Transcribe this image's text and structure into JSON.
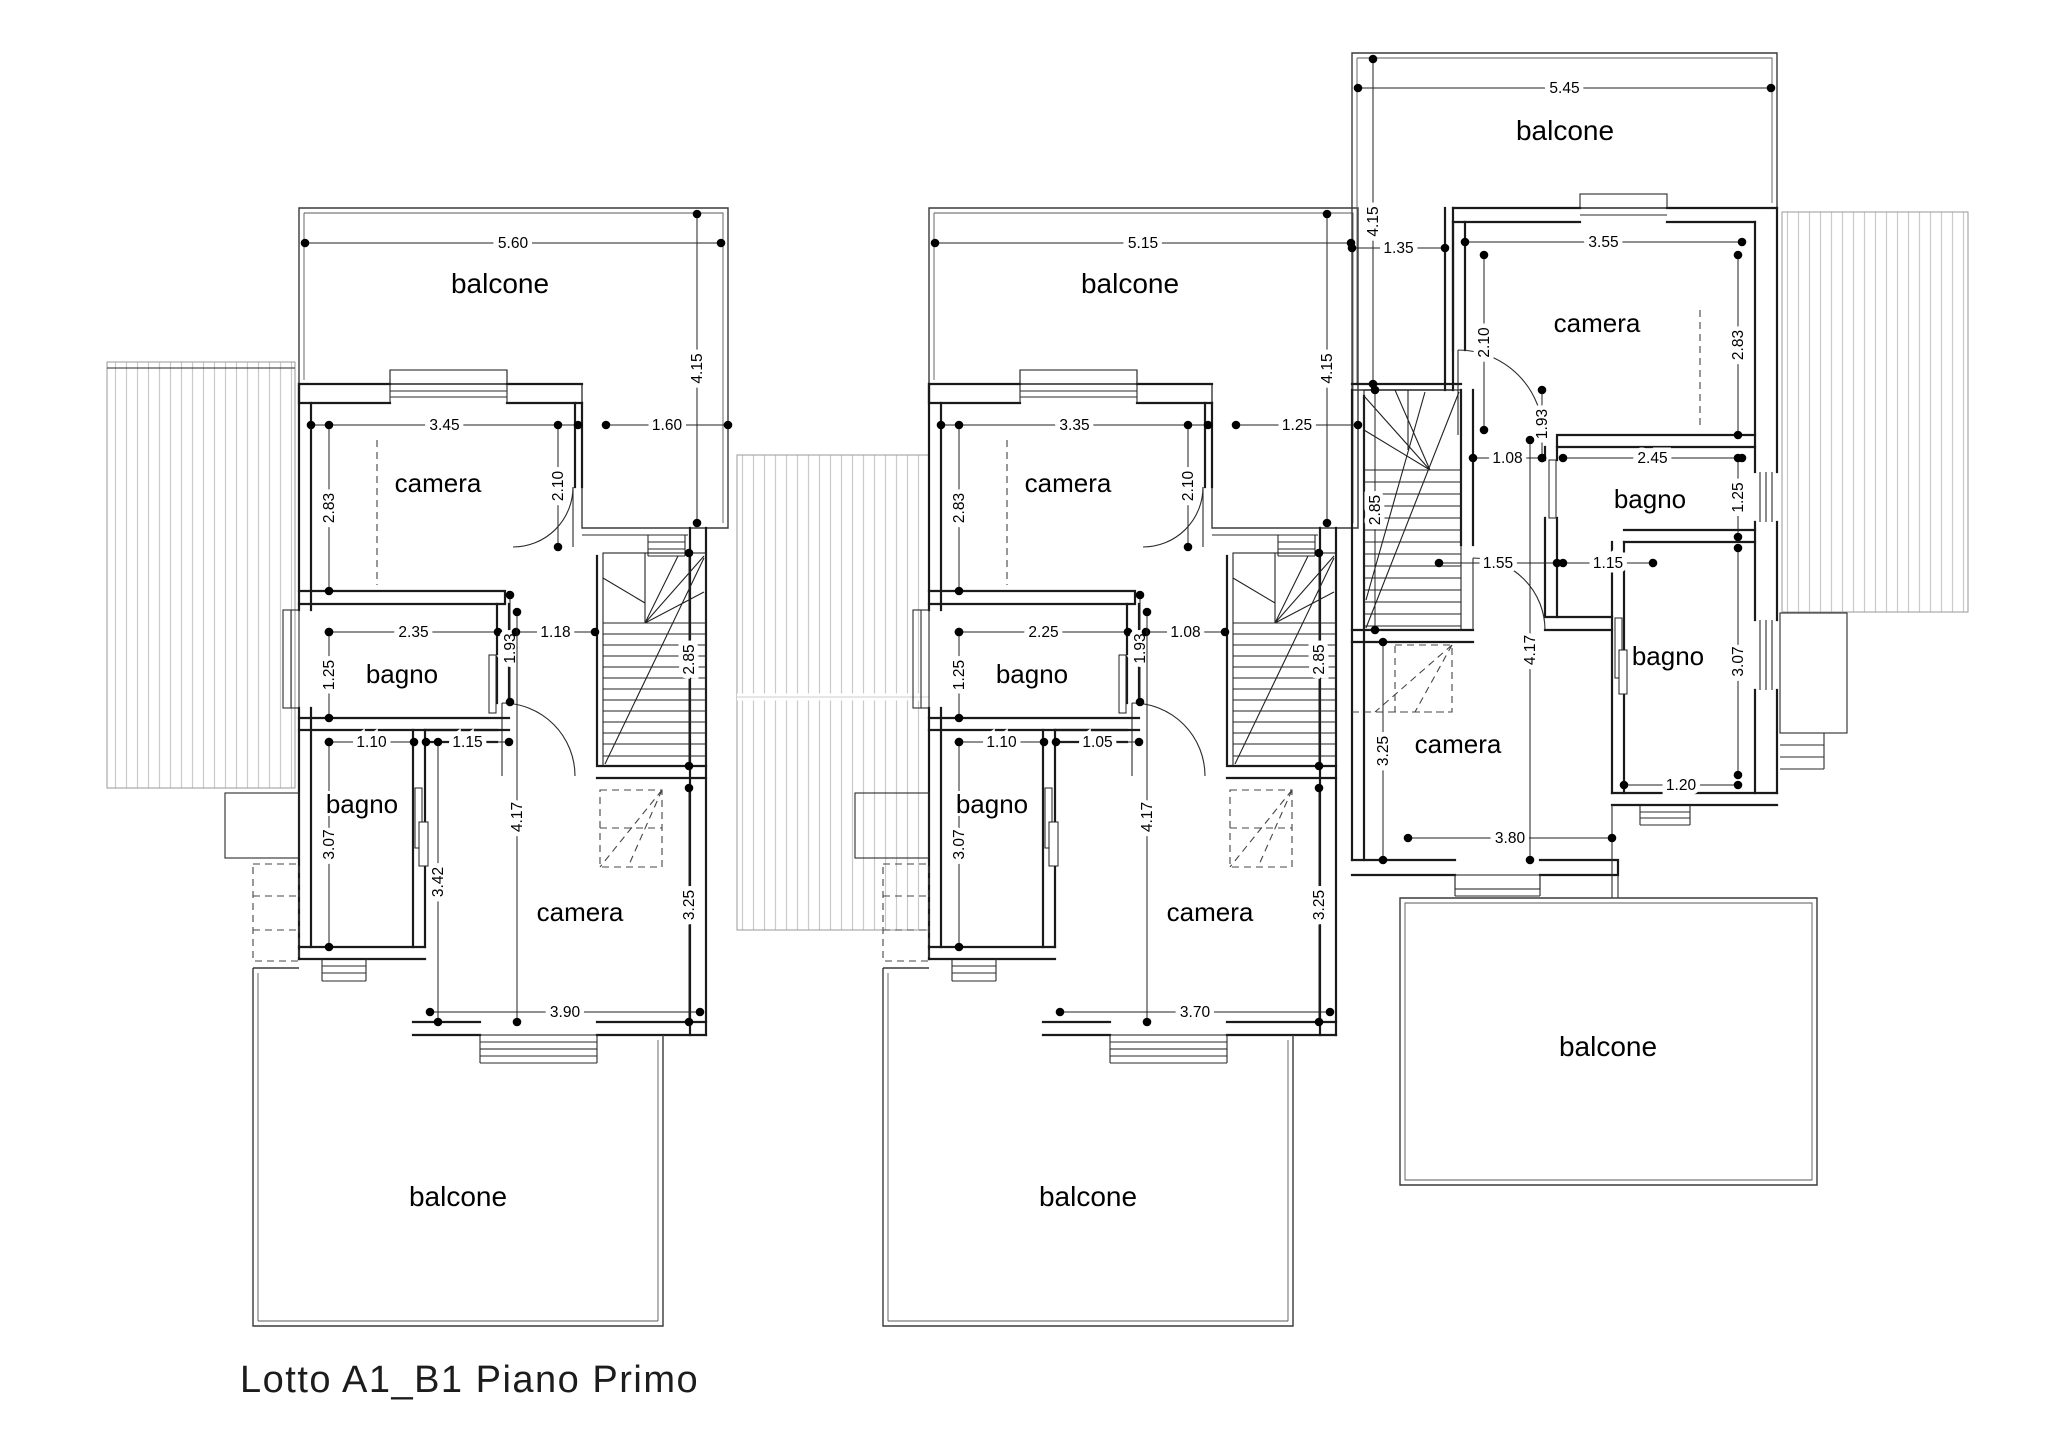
{
  "title": "Lotto A1_B1 Piano Primo",
  "plan": {
    "dot_radius": 4.3,
    "units": [
      {
        "id": "a",
        "rooms": [
          {
            "label": "balcone",
            "x": 500,
            "y": 293,
            "fs": 28
          },
          {
            "label": "camera",
            "x": 438,
            "y": 492,
            "fs": 26
          },
          {
            "label": "bagno",
            "x": 402,
            "y": 683,
            "fs": 26
          },
          {
            "label": "bagno",
            "x": 362,
            "y": 813,
            "fs": 26
          },
          {
            "label": "camera",
            "x": 580,
            "y": 921,
            "fs": 26
          },
          {
            "label": "balcone",
            "x": 458,
            "y": 1206,
            "fs": 28
          }
        ],
        "dims": [
          {
            "v": "5.60",
            "o": "h",
            "x1": 305,
            "x2": 721,
            "y": 243
          },
          {
            "v": "4.15",
            "o": "v",
            "x": 697,
            "y1": 214,
            "y2": 523
          },
          {
            "v": "3.45",
            "o": "h",
            "x1": 311,
            "x2": 578,
            "y": 425
          },
          {
            "v": "1.60",
            "o": "h",
            "x1": 606,
            "x2": 728,
            "y": 425
          },
          {
            "v": "2.83",
            "o": "v",
            "x": 329,
            "y1": 425,
            "y2": 591
          },
          {
            "v": "2.10",
            "o": "v",
            "x": 558,
            "y1": 425,
            "y2": 547
          },
          {
            "v": "2.35",
            "o": "h",
            "x1": 329,
            "x2": 498,
            "y": 632
          },
          {
            "v": "1.93",
            "o": "v",
            "x": 510,
            "y1": 595,
            "y2": 702
          },
          {
            "v": "1.18",
            "o": "h",
            "x1": 516,
            "x2": 595,
            "y": 632
          },
          {
            "v": "1.25",
            "o": "v",
            "x": 329,
            "y1": 632,
            "y2": 718
          },
          {
            "v": "2.85",
            "o": "v",
            "x": 689,
            "y1": 553,
            "y2": 766
          },
          {
            "v": "1.10",
            "o": "h",
            "x1": 329,
            "x2": 414,
            "y": 742
          },
          {
            "v": "1.15",
            "o": "h",
            "x1": 426,
            "x2": 509,
            "y": 742
          },
          {
            "v": "3.07",
            "o": "v",
            "x": 329,
            "y1": 742,
            "y2": 947
          },
          {
            "v": "3.42",
            "o": "v",
            "x": 438,
            "y1": 742,
            "y2": 1022
          },
          {
            "v": "4.17",
            "o": "v",
            "x": 517,
            "y1": 612,
            "y2": 1022
          },
          {
            "v": "3.25",
            "o": "v",
            "x": 689,
            "y1": 788,
            "y2": 1022
          },
          {
            "v": "3.90",
            "o": "h",
            "x1": 430,
            "x2": 700,
            "y": 1012
          }
        ]
      },
      {
        "id": "b",
        "rooms": [
          {
            "label": "balcone",
            "x": 1130,
            "y": 293,
            "fs": 28
          },
          {
            "label": "camera",
            "x": 1068,
            "y": 492,
            "fs": 26
          },
          {
            "label": "bagno",
            "x": 1032,
            "y": 683,
            "fs": 26
          },
          {
            "label": "bagno",
            "x": 992,
            "y": 813,
            "fs": 26
          },
          {
            "label": "camera",
            "x": 1210,
            "y": 921,
            "fs": 26
          },
          {
            "label": "balcone",
            "x": 1088,
            "y": 1206,
            "fs": 28
          }
        ],
        "dims": [
          {
            "v": "5.15",
            "o": "h",
            "x1": 935,
            "x2": 1351,
            "y": 243
          },
          {
            "v": "4.15",
            "o": "v",
            "x": 1327,
            "y1": 214,
            "y2": 523
          },
          {
            "v": "3.35",
            "o": "h",
            "x1": 941,
            "x2": 1208,
            "y": 425
          },
          {
            "v": "1.25",
            "o": "h",
            "x1": 1236,
            "x2": 1358,
            "y": 425
          },
          {
            "v": "2.83",
            "o": "v",
            "x": 959,
            "y1": 425,
            "y2": 591
          },
          {
            "v": "2.10",
            "o": "v",
            "x": 1188,
            "y1": 425,
            "y2": 547
          },
          {
            "v": "2.25",
            "o": "h",
            "x1": 959,
            "x2": 1128,
            "y": 632
          },
          {
            "v": "1.93",
            "o": "v",
            "x": 1140,
            "y1": 595,
            "y2": 702
          },
          {
            "v": "1.08",
            "o": "h",
            "x1": 1146,
            "x2": 1225,
            "y": 632
          },
          {
            "v": "1.25",
            "o": "v",
            "x": 959,
            "y1": 632,
            "y2": 718
          },
          {
            "v": "2.85",
            "o": "v",
            "x": 1319,
            "y1": 553,
            "y2": 766
          },
          {
            "v": "1.10",
            "o": "h",
            "x1": 959,
            "x2": 1044,
            "y": 742
          },
          {
            "v": "1.05",
            "o": "h",
            "x1": 1056,
            "x2": 1139,
            "y": 742
          },
          {
            "v": "3.07",
            "o": "v",
            "x": 959,
            "y1": 742,
            "y2": 947
          },
          {
            "v": "4.17",
            "o": "v",
            "x": 1147,
            "y1": 612,
            "y2": 1022
          },
          {
            "v": "3.25",
            "o": "v",
            "x": 1319,
            "y1": 788,
            "y2": 1022
          },
          {
            "v": "3.70",
            "o": "h",
            "x1": 1060,
            "x2": 1330,
            "y": 1012
          }
        ]
      },
      {
        "id": "c",
        "rooms": [
          {
            "label": "balcone",
            "x": 1565,
            "y": 140,
            "fs": 28
          },
          {
            "label": "camera",
            "x": 1597,
            "y": 332,
            "fs": 26
          },
          {
            "label": "bagno",
            "x": 1650,
            "y": 508,
            "fs": 26
          },
          {
            "label": "bagno",
            "x": 1668,
            "y": 665,
            "fs": 26
          },
          {
            "label": "camera",
            "x": 1458,
            "y": 753,
            "fs": 26
          },
          {
            "label": "balcone",
            "x": 1608,
            "y": 1056,
            "fs": 28
          }
        ],
        "dims": [
          {
            "v": "5.45",
            "o": "h",
            "x1": 1358,
            "x2": 1771,
            "y": 88
          },
          {
            "v": "4.15",
            "o": "v",
            "x": 1373,
            "y1": 59,
            "y2": 384
          },
          {
            "v": "1.35",
            "o": "h",
            "x1": 1352,
            "x2": 1445,
            "y": 248
          },
          {
            "v": "3.55",
            "o": "h",
            "x1": 1465,
            "x2": 1742,
            "y": 242
          },
          {
            "v": "2.10",
            "o": "v",
            "x": 1484,
            "y1": 255,
            "y2": 430
          },
          {
            "v": "2.83",
            "o": "v",
            "x": 1738,
            "y1": 255,
            "y2": 435
          },
          {
            "v": "1.93",
            "o": "v",
            "x": 1542,
            "y1": 390,
            "y2": 458
          },
          {
            "v": "1.08",
            "o": "h",
            "x1": 1473,
            "x2": 1542,
            "y": 458
          },
          {
            "v": "2.45",
            "o": "h",
            "x1": 1563,
            "x2": 1742,
            "y": 458
          },
          {
            "v": "1.25",
            "o": "v",
            "x": 1738,
            "y1": 458,
            "y2": 537
          },
          {
            "v": "2.85",
            "o": "v",
            "x": 1375,
            "y1": 390,
            "y2": 630
          },
          {
            "v": "1.55",
            "o": "h",
            "x1": 1439,
            "x2": 1557,
            "y": 563
          },
          {
            "v": "1.15",
            "o": "h",
            "x1": 1563,
            "x2": 1653,
            "y": 563
          },
          {
            "v": "3.07",
            "o": "v",
            "x": 1738,
            "y1": 548,
            "y2": 775
          },
          {
            "v": "3.25",
            "o": "v",
            "x": 1383,
            "y1": 642,
            "y2": 860
          },
          {
            "v": "4.17",
            "o": "v",
            "x": 1530,
            "y1": 440,
            "y2": 860
          },
          {
            "v": "3.80",
            "o": "h",
            "x1": 1408,
            "x2": 1612,
            "y": 838
          },
          {
            "v": "1.20",
            "o": "h",
            "x1": 1624,
            "x2": 1738,
            "y": 785
          }
        ]
      }
    ]
  }
}
